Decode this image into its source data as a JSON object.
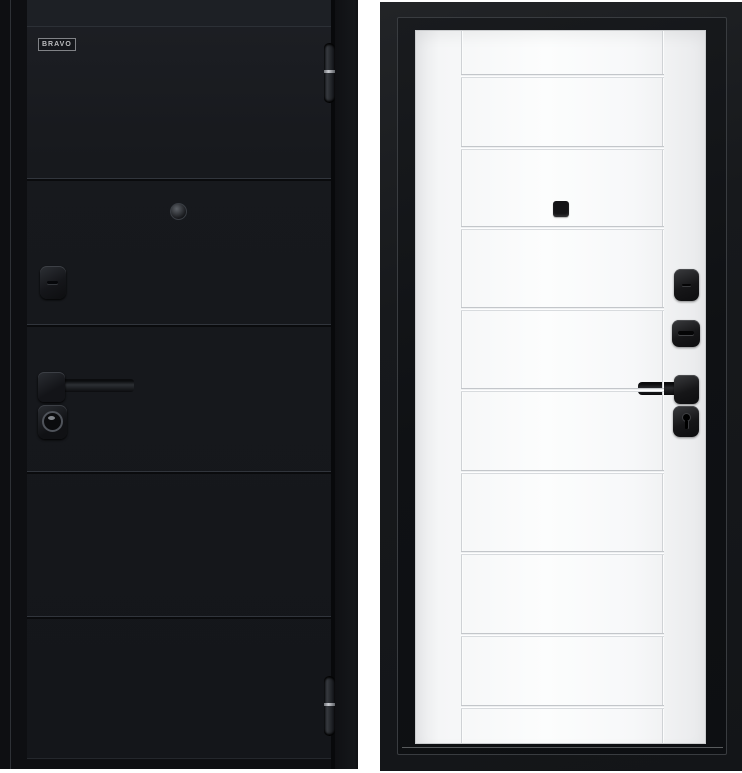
{
  "logo": {
    "text": "BRAVO"
  },
  "colors": {
    "background": "#ffffff",
    "exterior_door": "#17191d",
    "exterior_frame": "#0e0f12",
    "interior_leaf": "#f7f8f9",
    "interior_frame": "#17191c",
    "hardware_black": "#141517",
    "chrome_accent": "#d8dbde"
  },
  "exterior_view": {
    "description": "black entrance door, outside face with frame",
    "panel_count": 5,
    "groove_y": [
      151,
      297,
      444,
      589
    ],
    "hardware": [
      "brand-logo-plate",
      "peephole",
      "keyhole-escutcheon",
      "lever-handle",
      "cylinder-lock",
      "hinge-top",
      "hinge-bottom"
    ]
  },
  "interior_view": {
    "description": "white inner face of the door with black frame",
    "panel_count": 10,
    "groove_y": [
      43,
      115,
      195,
      276,
      357,
      439,
      520,
      602,
      674
    ],
    "vertical_groove_x": [
      45,
      246
    ],
    "hardware": [
      "peephole",
      "thumbturn-escutcheon",
      "lock-escutcheon",
      "lever-handle",
      "cylinder-escutcheon"
    ]
  }
}
